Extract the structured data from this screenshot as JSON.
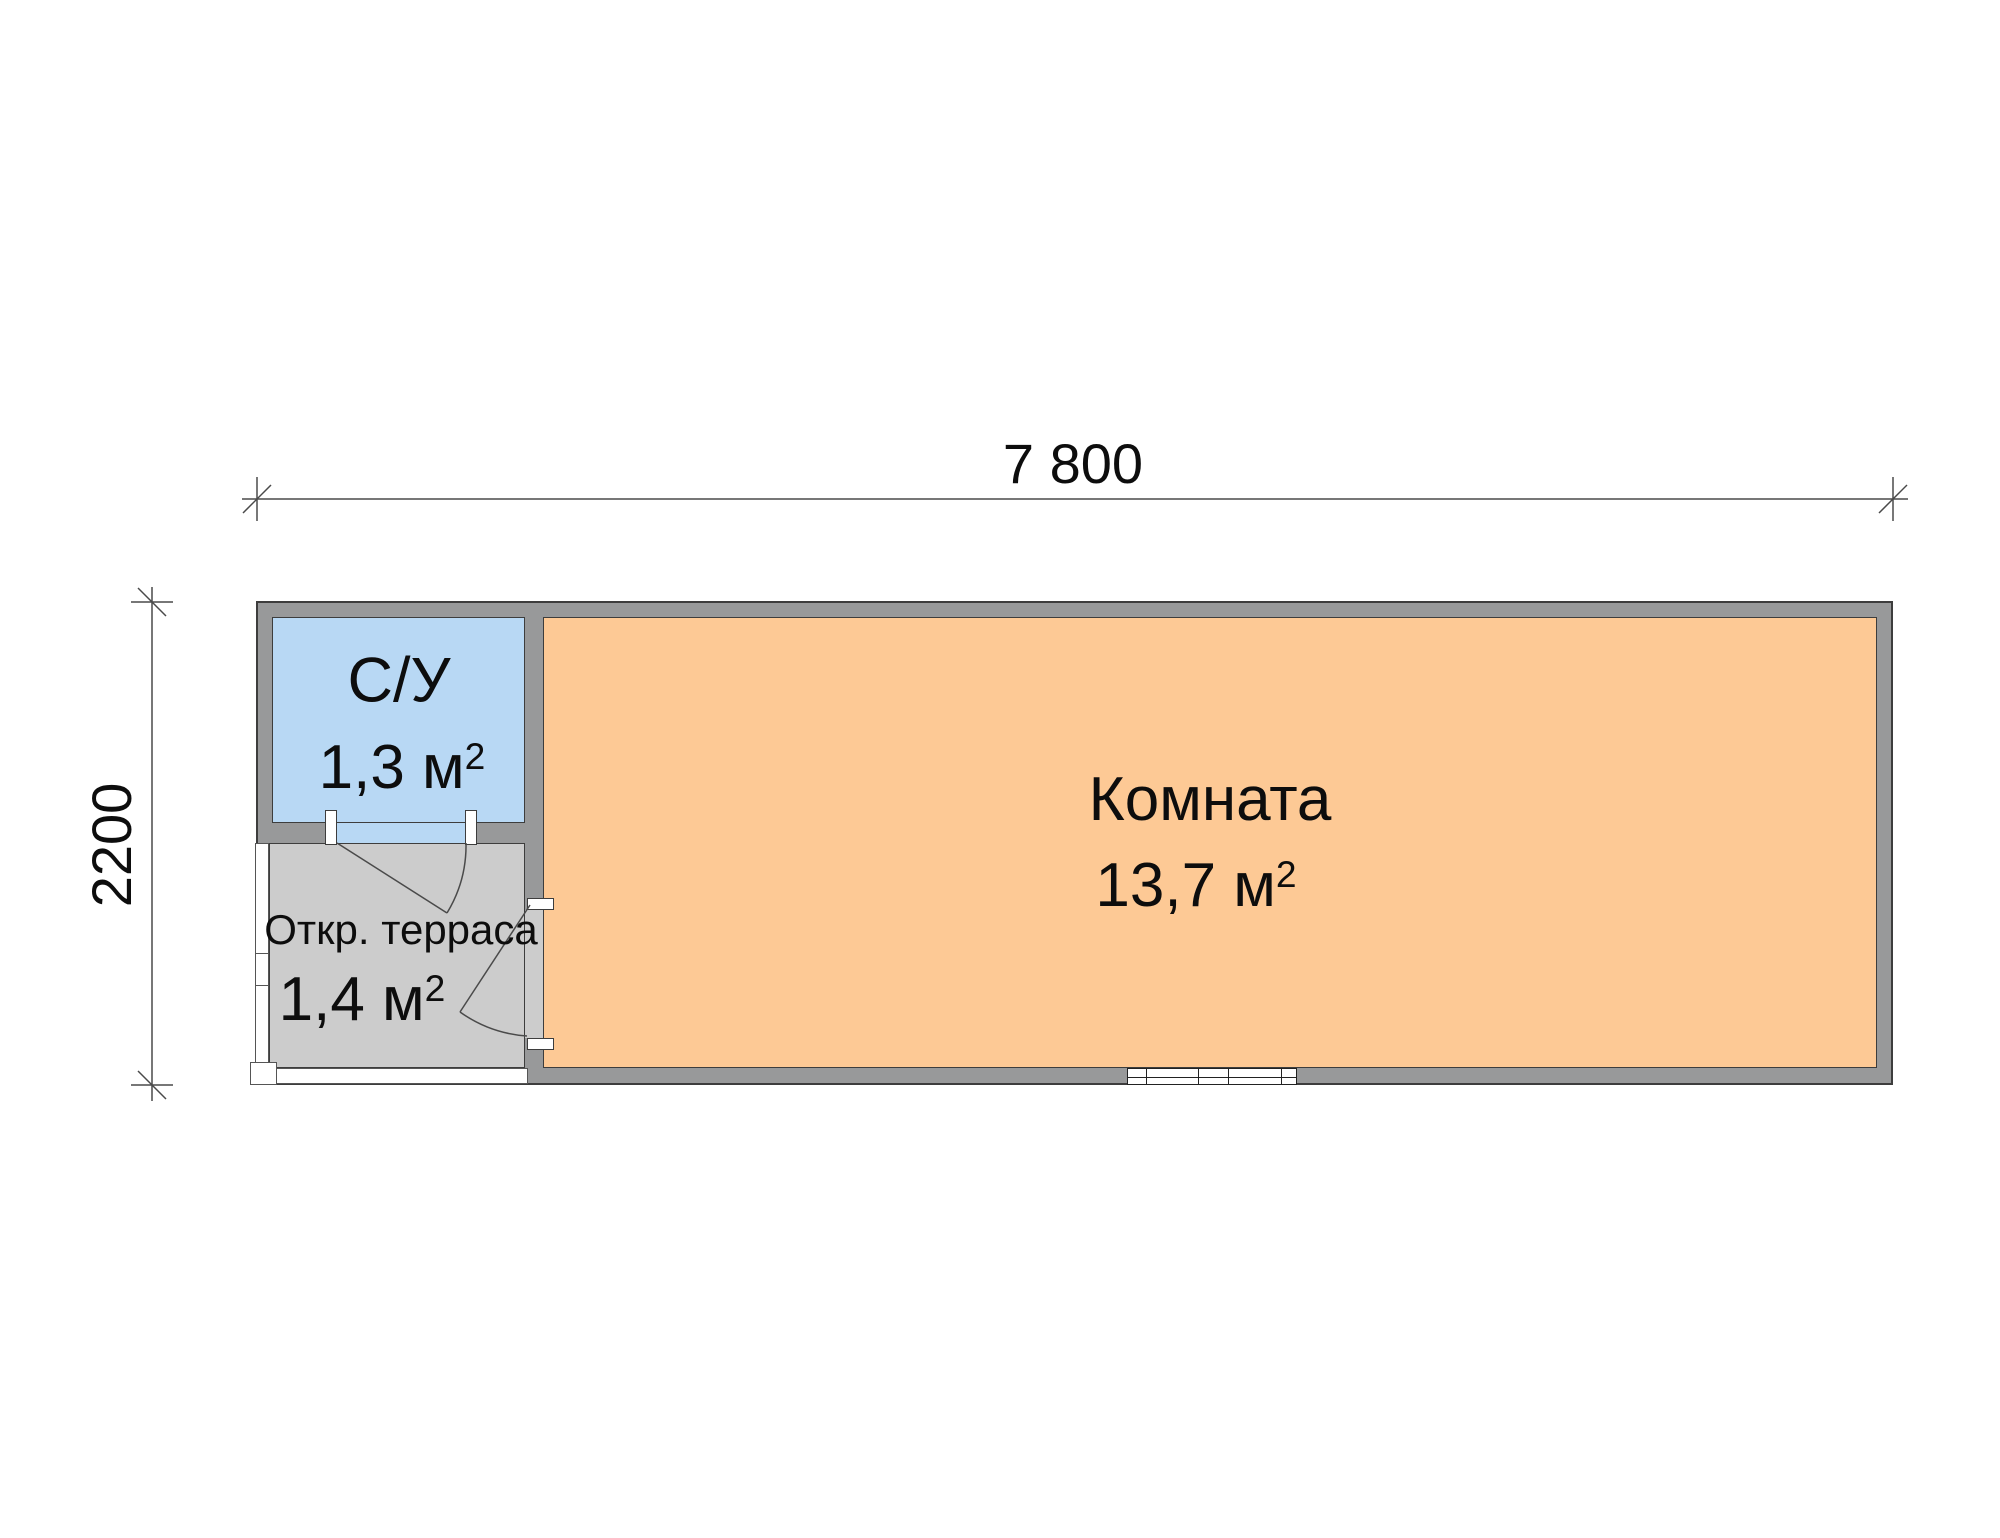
{
  "dimensions": {
    "width": "7 800",
    "height": "2200"
  },
  "rooms": {
    "bathroom": {
      "name": "С/У",
      "area": "1,3 м",
      "area_sup": "2"
    },
    "living": {
      "name": "Комната",
      "area": "13,7 м",
      "area_sup": "2"
    },
    "terrace": {
      "name": "Откр. терраса",
      "area": "1,4 м",
      "area_sup": "2"
    }
  },
  "colors": {
    "bathroom_fill": "#b8d8f4",
    "living_fill": "#fdc995",
    "terrace_fill": "#cccccc",
    "wall_fill": "#98999a",
    "outline": "#3d3d3d",
    "dimension_lines": "#4a4a4a",
    "text": "#0d0d0d"
  }
}
